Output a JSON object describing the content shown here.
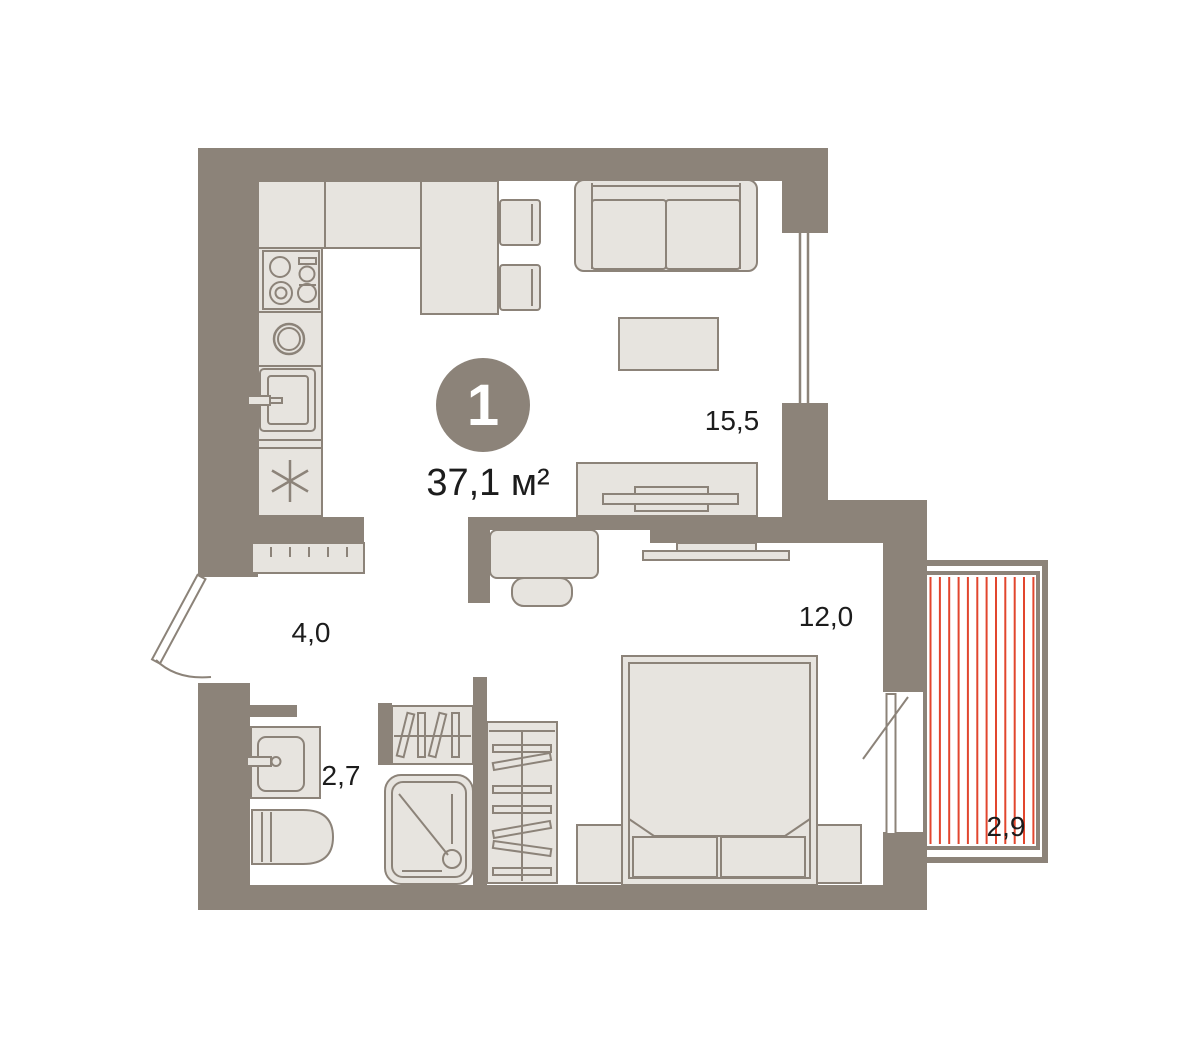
{
  "floorplan": {
    "badge": {
      "rooms_count": "1",
      "total_area": "37,1 м²"
    },
    "rooms": [
      {
        "name": "living-room-kitchen",
        "area": "15,5"
      },
      {
        "name": "bedroom",
        "area": "12,0"
      },
      {
        "name": "hallway",
        "area": "4,0"
      },
      {
        "name": "bathroom",
        "area": "2,7"
      },
      {
        "name": "balcony",
        "area": "2,9"
      }
    ],
    "colors": {
      "background": "#ffffff",
      "wall": "#8c8379",
      "furniture-fill": "#e7e4df",
      "furniture-stroke": "#8c8379",
      "balcony-hatch": "#e2462e",
      "label-text": "#1c1c1c",
      "badge-fill": "#8c8379",
      "badge-text": "#ffffff"
    }
  }
}
